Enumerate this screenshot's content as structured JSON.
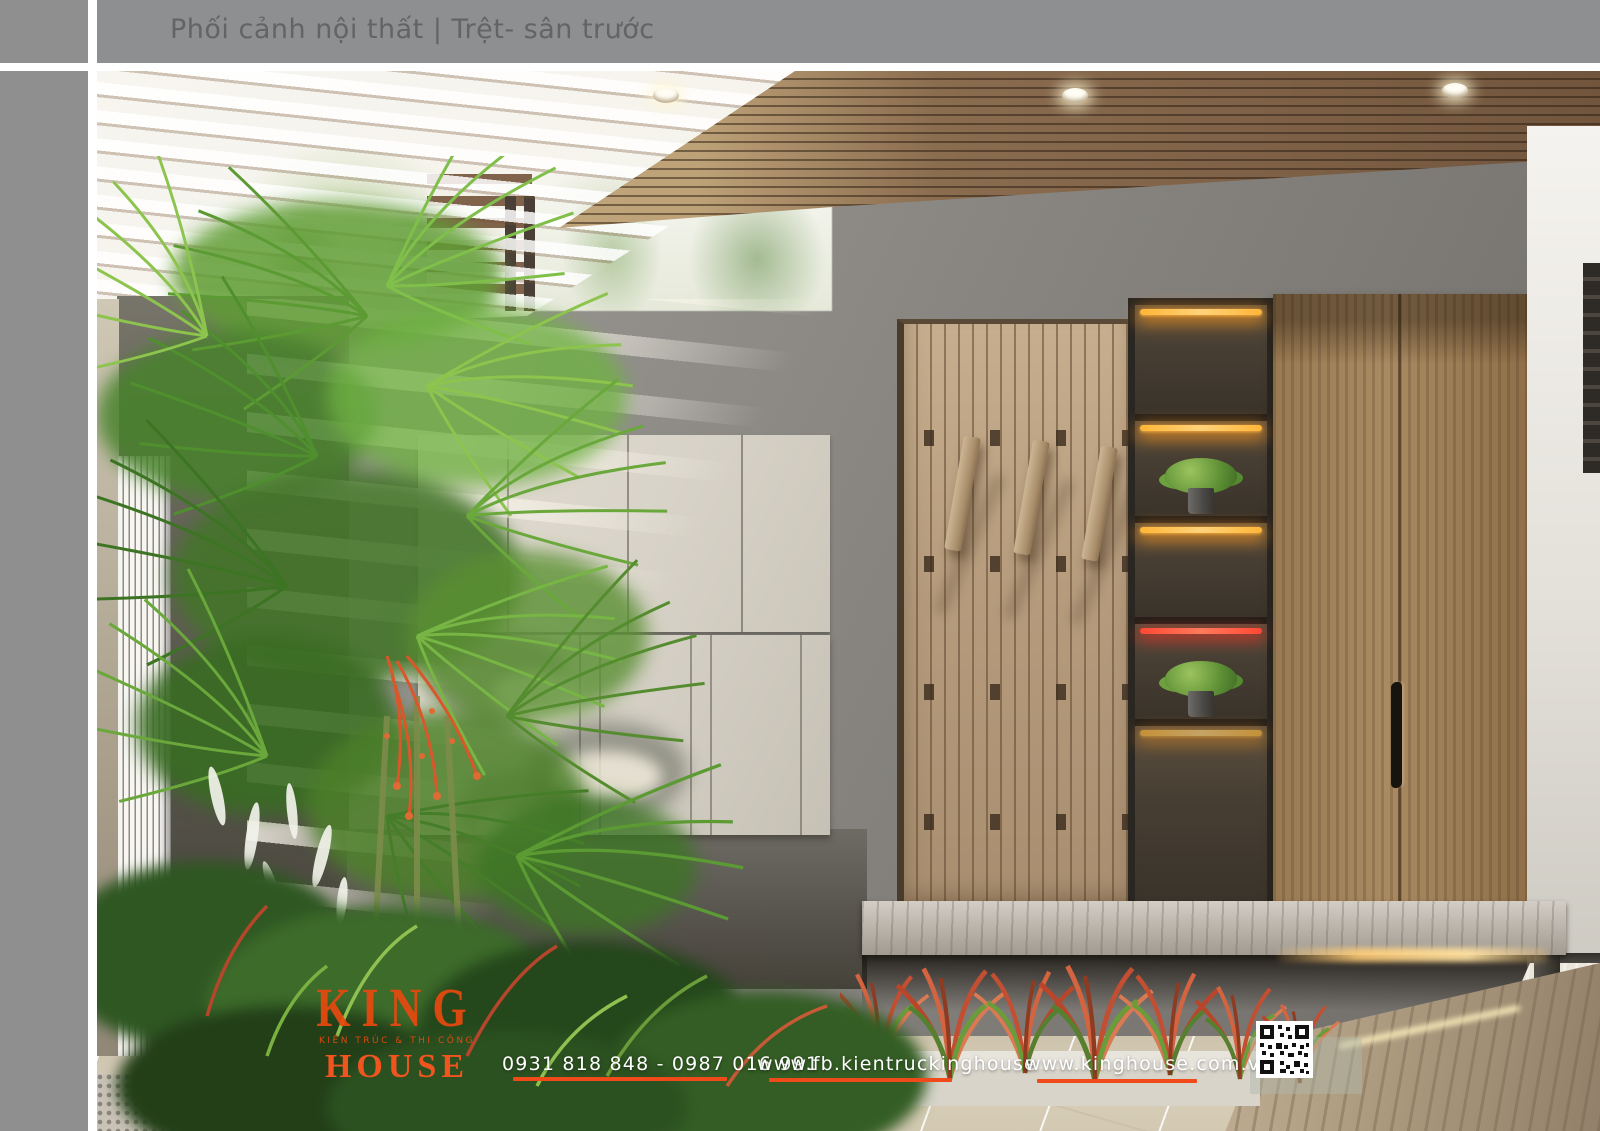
{
  "header": {
    "title": "Phối cảnh nội thất | Trệt- sân trước"
  },
  "footer": {
    "logo": {
      "word_top": "KING",
      "tagline": "KIẾN TRÚC & THI CÔNG",
      "word_bottom": "HOUSE"
    },
    "phone_numbers": "0931 818 848 - 0987 016 991",
    "facebook_url": "www.fb.kientruckinghouse",
    "website_url": "www.kinghouse.com.vn",
    "qr_icon": "qr-code-icon"
  },
  "colors": {
    "accent_orange": "#F1551F",
    "underline_orange": "#F04A1A",
    "frame_gray": "#8E8F91",
    "title_text_gray": "#646464",
    "ceiling_wood": "#8A6C4F",
    "slat_panel_wood": "#B69C7D",
    "wardrobe_wood": "#9A7A52",
    "led_warm": "#FFB637",
    "led_red": "#FF4833",
    "concrete_wall": "#8F8C88",
    "cabinet_cream": "#D8D3C8",
    "foliage_green": "#5D8F35"
  }
}
